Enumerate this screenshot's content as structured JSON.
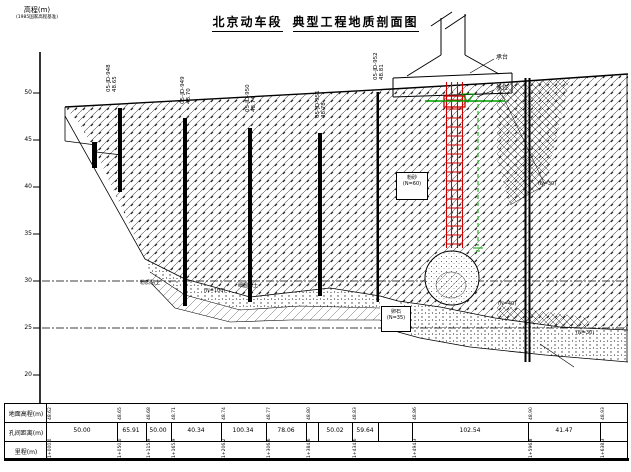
{
  "title": {
    "part1": "北京动车段",
    "part2": "典型工程地质剖面图"
  },
  "axis": {
    "label": "高程(m)",
    "datum": "(1985国家高程基准)",
    "ticks": [
      "50",
      "45",
      "40",
      "35",
      "30",
      "25",
      "20"
    ]
  },
  "boreholes": [
    {
      "id": "05-JD-948",
      "elev": "48.65"
    },
    {
      "id": "05-JD-949",
      "elev": "48.70"
    },
    {
      "id": "05-JD-950",
      "elev": "48.74"
    },
    {
      "id": "05-JD-951",
      "elev": "48.78"
    },
    {
      "id": "05-JD-952",
      "elev": "48.81"
    }
  ],
  "structure": {
    "cap": "承台",
    "water": "水位"
  },
  "boxes": [
    {
      "l1": "粉砂",
      "l2": "(N=60)"
    },
    {
      "l1": "卵石",
      "l2": "(N=35)"
    }
  ],
  "labels": {
    "l1": "粉质黏土",
    "l2": "细圆砾土",
    "l3": "(N=100)",
    "l4": "(N=30)",
    "l5": "(N=40)",
    "l6": "(N=30)"
  },
  "table": {
    "rows": [
      "地面高程(m)",
      "孔间距离(m)",
      "里程(m)"
    ],
    "elevations": [
      "48.62",
      "48.65",
      "48.68",
      "48.71",
      "48.74",
      "48.77",
      "48.80",
      "48.83",
      "48.86",
      "48.90",
      "48.93"
    ],
    "spacings": [
      "50.00",
      "65.91",
      "50.00",
      "40.34",
      "100.34",
      "78.06",
      "50.02",
      "59.64",
      "102.54",
      "41.47"
    ],
    "mileages": [
      "1+000.0",
      "1+050.0",
      "1+115.9",
      "1+165.9",
      "1+206.2",
      "1+306.6",
      "1+384.6",
      "1+434.6",
      "1+494.3",
      "1+596.8",
      "1+638.3"
    ]
  },
  "colors": {
    "pile_red": "#cc0000",
    "water_green": "#00a000"
  }
}
